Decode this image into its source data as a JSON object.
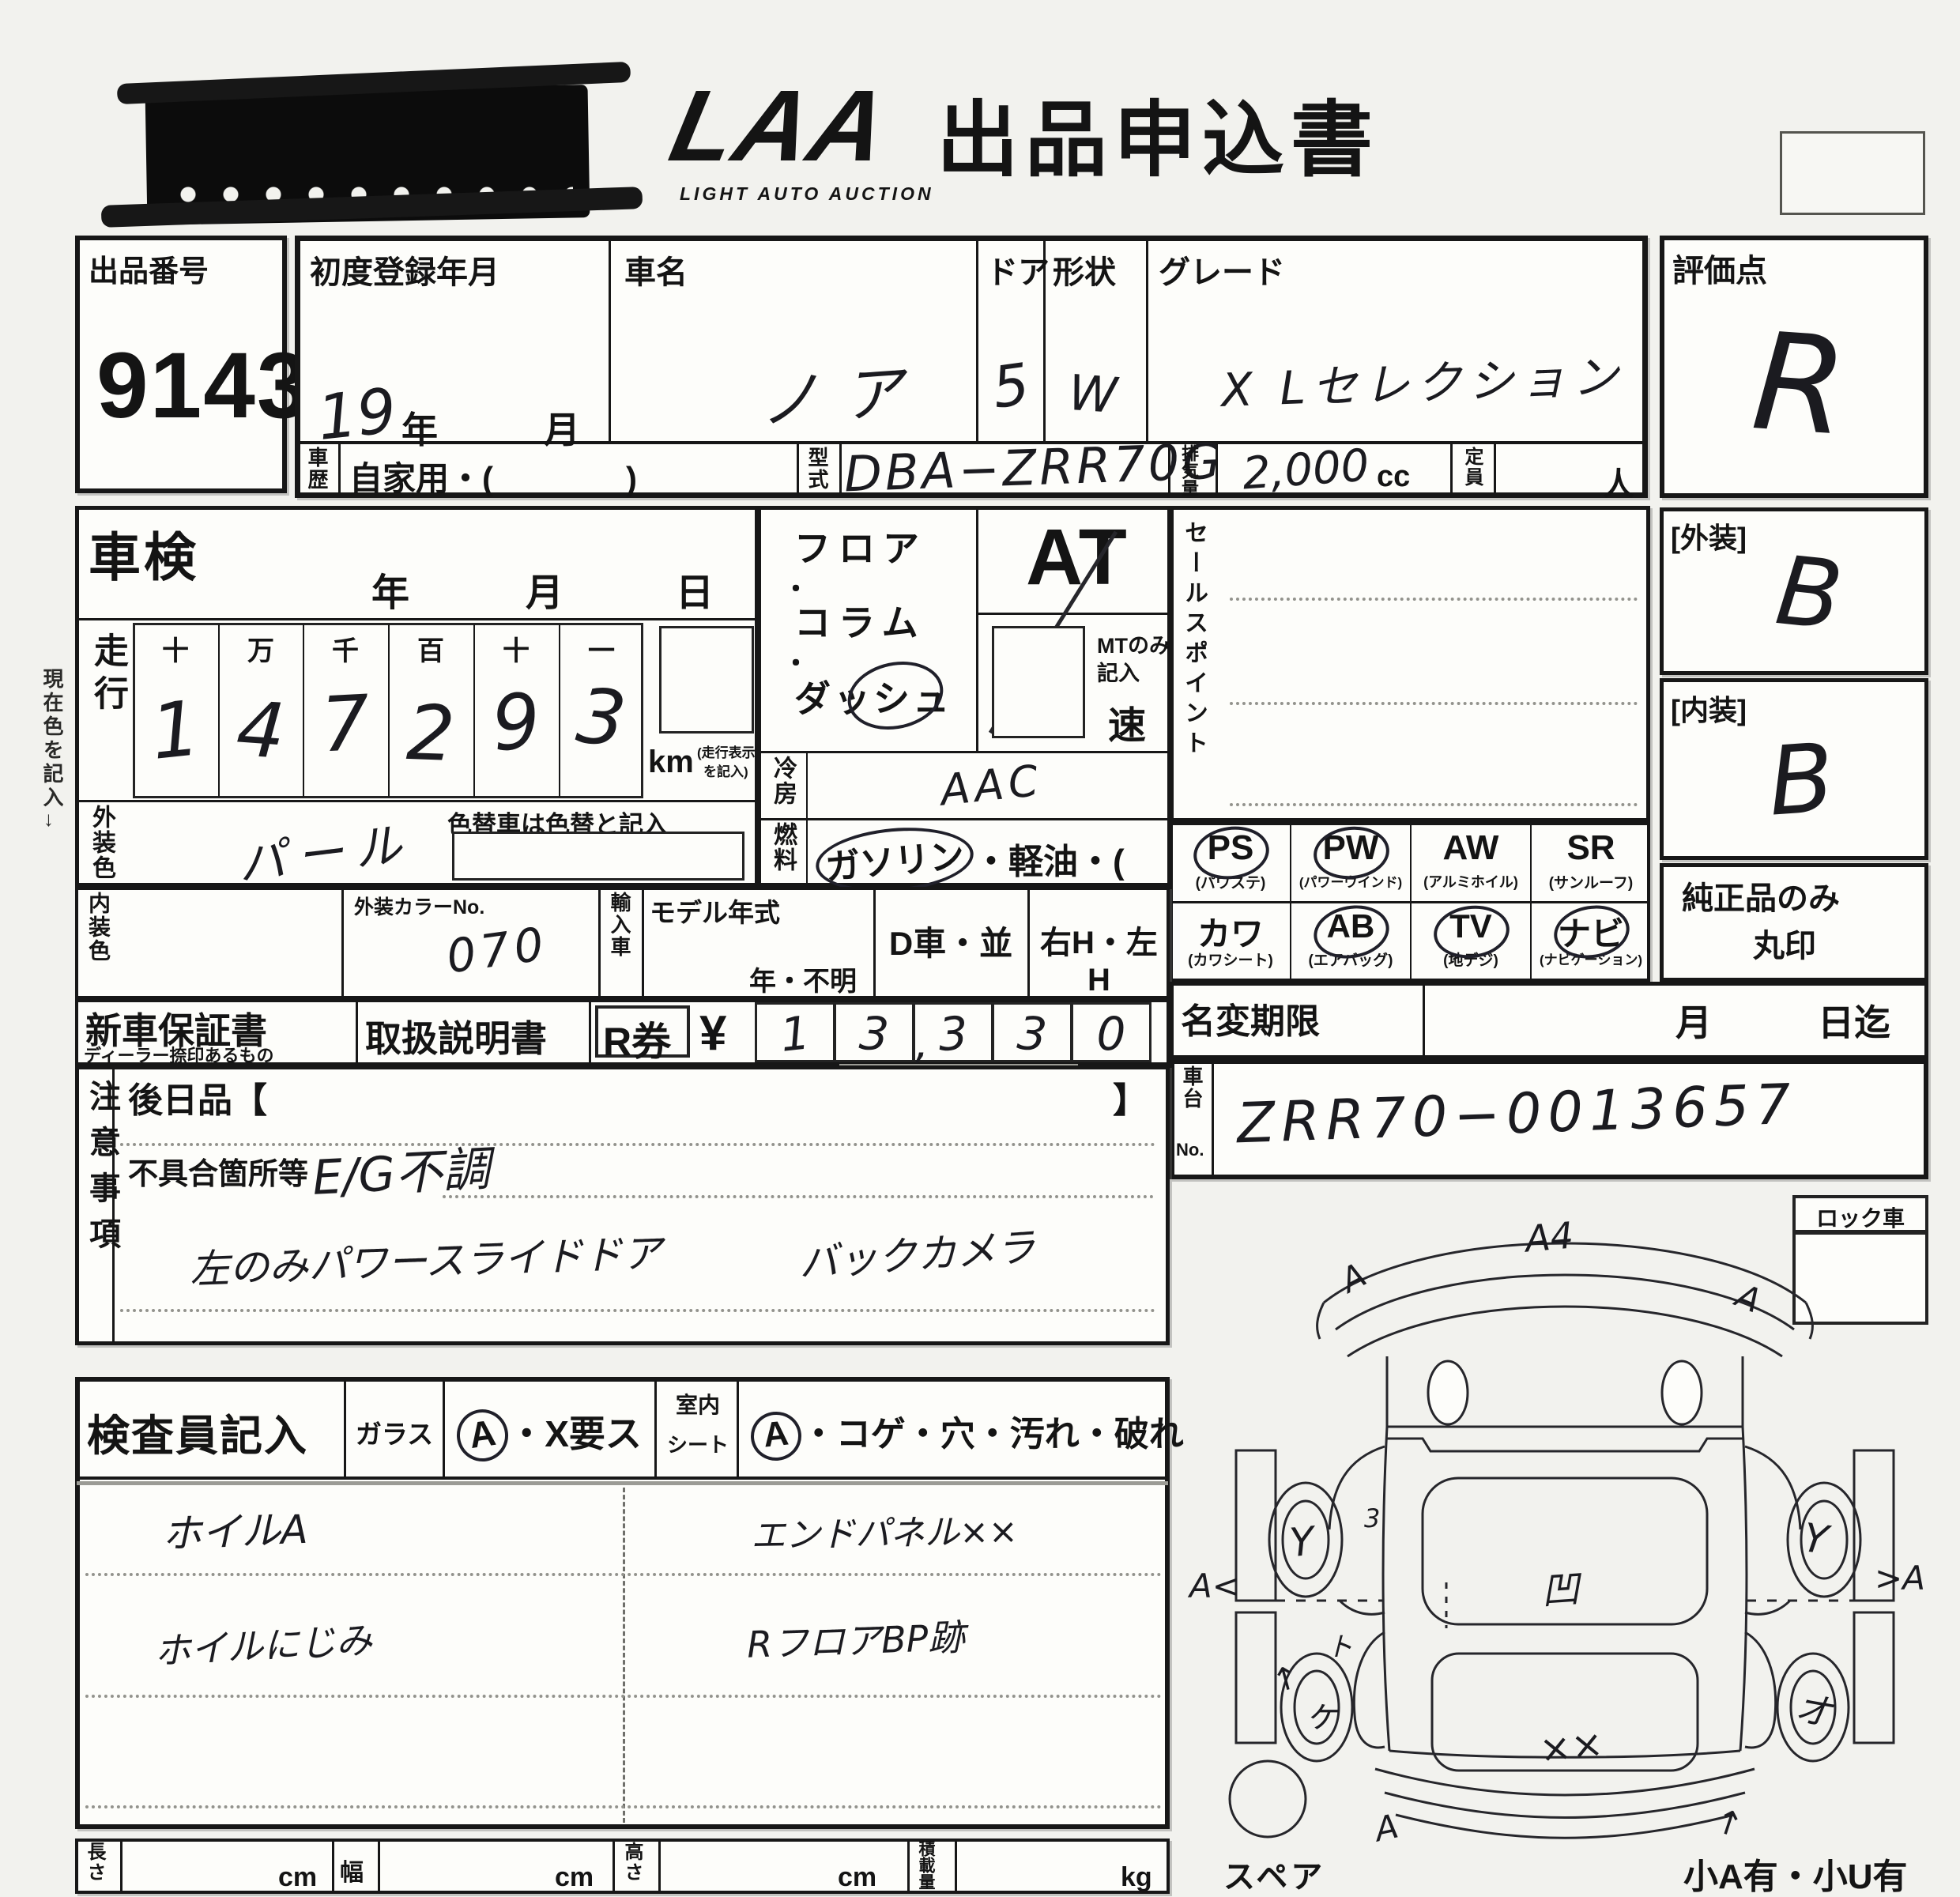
{
  "header": {
    "logo": "LAA",
    "logo_sub": "LIGHT AUTO AUCTION",
    "title": "出品申込書"
  },
  "auction_no": {
    "label": "出品番号",
    "value": "9143"
  },
  "rating": {
    "label": "評価点",
    "value": "R"
  },
  "reg": {
    "label": "初度登録年月",
    "value": "19",
    "year": "年",
    "month": "月"
  },
  "car": {
    "label": "車名",
    "value": "ノア"
  },
  "door": {
    "label": "ドア",
    "value": "5"
  },
  "shape": {
    "label": "形状",
    "value": "W"
  },
  "grade": {
    "label": "グレード",
    "value": "X Lセレクション"
  },
  "history": {
    "label": "車歴",
    "value": "自家用・(　　　　)"
  },
  "model": {
    "label": "型式",
    "value": "DBA−ZRR70G"
  },
  "disp": {
    "label": "排気量",
    "value": "2,000",
    "unit": "cc"
  },
  "capacity": {
    "label": "定員",
    "unit": "人"
  },
  "shaken": {
    "label": "車検",
    "year": "年",
    "month": "月",
    "day": "日"
  },
  "mileage": {
    "label": "走行",
    "headers": [
      "十",
      "万",
      "千",
      "百",
      "十",
      "一"
    ],
    "digits": [
      "1",
      "4",
      "7",
      "2",
      "9",
      "3"
    ],
    "unit": "km",
    "note1": "(走行表示マーク",
    "note2": "を記入)"
  },
  "ext_color": {
    "label": "外装色",
    "value": "パール",
    "note": "色替車は色替と記入"
  },
  "int_color": {
    "label": "内装色",
    "no_label": "外装カラーNo.",
    "no_value": "070"
  },
  "importcar": {
    "label": "輸入車",
    "model_year": "モデル年式",
    "unknown": "年・不明",
    "dcar": "D車・並",
    "handle": "右H・左H"
  },
  "position": {
    "l1": "フロア",
    "dot1": "・",
    "l2": "コラム",
    "dot2": "・",
    "l3": "ダッシュ"
  },
  "trans": {
    "at": "AT",
    "mt1": "MTのみ",
    "mt2": "記入",
    "speed": "速"
  },
  "ac": {
    "label": "冷房",
    "value": "AAC"
  },
  "fuel": {
    "label": "燃料",
    "opt1": "ガソリン",
    "rest": "・軽油・(　　　　)"
  },
  "sales": {
    "label": "セールスポイント"
  },
  "ext_rate": {
    "label": "[外装]",
    "value": "B"
  },
  "int_rate": {
    "label": "[内装]",
    "value": "B"
  },
  "equip": {
    "items": [
      {
        "code": "PS",
        "sub": "(パワステ)"
      },
      {
        "code": "PW",
        "sub": "(パワーウインド)"
      },
      {
        "code": "AW",
        "sub": "(アルミホイル)"
      },
      {
        "code": "SR",
        "sub": "(サンルーフ)"
      },
      {
        "code": "カワ",
        "sub": "(カワシート)"
      },
      {
        "code": "AB",
        "sub": "(エアバッグ)"
      },
      {
        "code": "TV",
        "sub": "(地デジ)"
      },
      {
        "code": "ナビ",
        "sub": "(ナビゲーション)"
      }
    ],
    "note1": "純正品のみ",
    "note2": "丸印"
  },
  "warranty": {
    "label": "新車保証書",
    "sub": "ディーラー捺印あるもの"
  },
  "manual": {
    "label": "取扱説明書"
  },
  "rticket": {
    "label": "R券",
    "yen": "¥",
    "digits": [
      "1",
      "3",
      "3",
      "3",
      "0"
    ],
    "comma": ","
  },
  "rename": {
    "label": "名変期限",
    "month": "月",
    "until": "日迄"
  },
  "chassis": {
    "label": "車台",
    "no_label": "No.",
    "value": "ZRR70−0013657"
  },
  "lock": {
    "label": "ロック車"
  },
  "notes": {
    "label": "注意事項",
    "later": "後日品【",
    "later_close": "】",
    "defect_label": "不具合箇所等",
    "defect1": "E/G不調",
    "line2a": "左のみパワースライドドア",
    "line2b": "バックカメラ"
  },
  "inspector": {
    "label": "検査員記入",
    "glass": "ガラス",
    "glass_a": "A",
    "glass_rest": "・X要ス",
    "cabin1": "室内",
    "cabin2": "シート",
    "seat_a": "A",
    "seat_rest": "・コゲ・穴・汚れ・破れ",
    "rows": [
      {
        "left": "ホイルA",
        "right": "エンドパネル××"
      },
      {
        "left": "ホイルにじみ",
        "right": "RフロアBP跡"
      }
    ]
  },
  "dims": {
    "length": "長さ",
    "width": "幅",
    "height": "高さ",
    "load": "積載量",
    "cm": "cm",
    "kg": "kg"
  },
  "diagram": {
    "spare": "スペア",
    "note": "小A有・小U有",
    "marks": [
      "A4",
      "A",
      "A",
      "Y",
      "Y",
      "A<",
      ">A",
      "3",
      "凹",
      "ヶ",
      "オ",
      "ト",
      "↑",
      "××",
      "A",
      "↑"
    ]
  }
}
